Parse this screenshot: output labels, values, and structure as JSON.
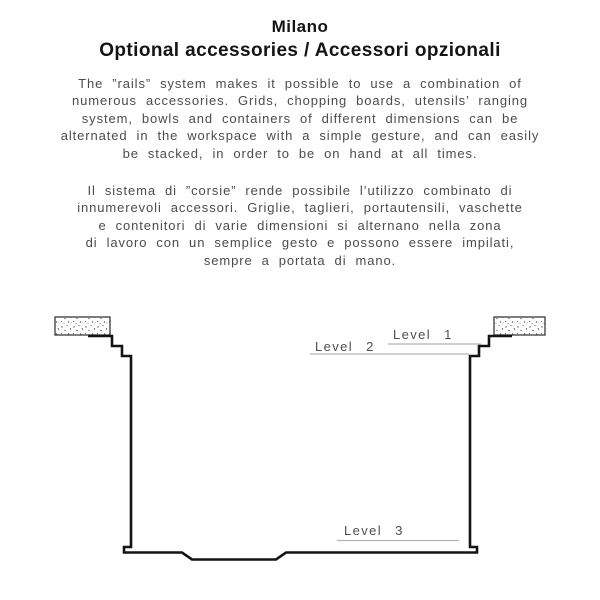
{
  "header": {
    "title": "Milano",
    "subtitle": "Optional accessories / Accessori opzionali"
  },
  "intro_en": {
    "lines": [
      "The ”rails” system makes it possible to use a combination of",
      "numerous accessories. Grids, chopping boards, utensils’ ranging",
      "system, bowls and containers of different dimensions can be",
      "alternated in the workspace with a simple gesture, and can easily",
      "be stacked, in order to be on hand at all times."
    ]
  },
  "intro_it": {
    "lines": [
      "Il sistema di ”corsie” rende possibile l’utilizzo combinato di",
      "innumerevoli accessori. Griglie, taglieri, portautensili, vaschette",
      "e contenitori di varie dimensioni si alternano nella zona",
      "di lavoro con un semplice gesto e possono essere impilati,",
      "sempre a portata di mano."
    ]
  },
  "diagram": {
    "description": "sink cross-section with three accessory levels",
    "levels": [
      {
        "label": "Level 1"
      },
      {
        "label": "Level 2"
      },
      {
        "label": "Level 3"
      }
    ],
    "colors": {
      "profile_line": "#141414",
      "leader_line": "#b5b5b5",
      "label_text": "#4f4f4f",
      "countertop_outline": "#2a2a2a"
    }
  }
}
